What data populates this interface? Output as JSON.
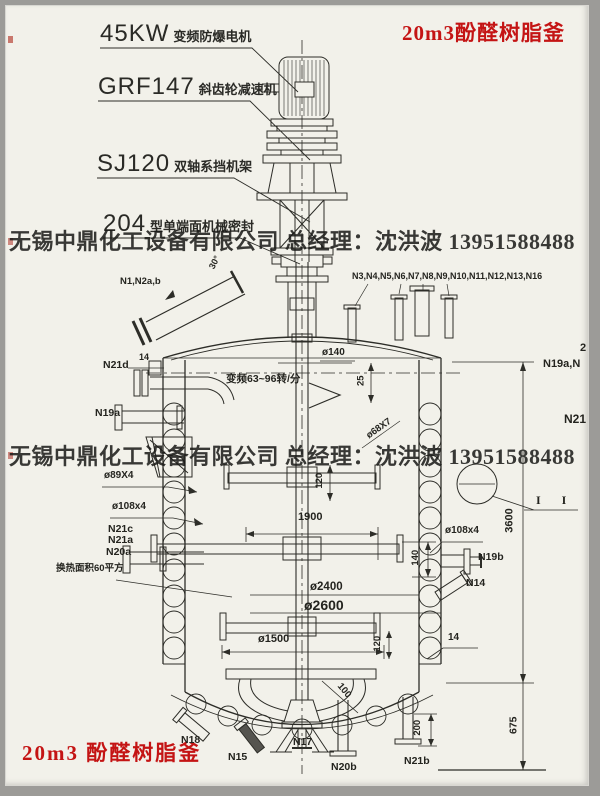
{
  "titles": {
    "top_right": "20m3酚醛树脂釜",
    "bottom_left": "20m3 酚醛树脂釜"
  },
  "watermarks": {
    "line1": "无锡中鼎化工设备有限公司 总经理：沈洪波 13951588488",
    "line2": "无锡中鼎化工设备有限公司 总经理：沈洪波 13951588488"
  },
  "callouts": [
    {
      "code": "45KW",
      "desc": "变频防爆电机"
    },
    {
      "code": "GRF147",
      "desc": "斜齿轮减速机"
    },
    {
      "code": "SJ120",
      "desc": "双轴系挡机架"
    },
    {
      "code": "204",
      "desc": "型单端面机械密封"
    }
  ],
  "nozzles": {
    "top_left": "N1,N2a,b",
    "top_right_row": "N3,N4,N5,N6,N7,N8,N9,N10,N11,N12,N13,N16",
    "n21d": "N21d",
    "n19a": "N19a",
    "n21c": "N21c",
    "n21a": "N21a",
    "n20a": "N20a",
    "n18": "N18",
    "n15": "N15",
    "n17": "N17",
    "n20b": "N20b",
    "n21b": "N21b",
    "n19b": "N19b",
    "n14": "N14",
    "edge_top": "2",
    "edge_mid": "N19a,N",
    "edge_bottom": "N21"
  },
  "dimensions": {
    "shaft_dia": "ø140",
    "dim25": "25",
    "dim14_left": "14",
    "dim14_right": "14",
    "coil_left_1": "ø89X4",
    "coil_left_2": "ø108x4",
    "coil_right": "ø108x4",
    "paddle_span": "1900",
    "dim140": "140",
    "dim120_upper": "120",
    "dim120_lower": "120",
    "dia_inner": "ø2400",
    "dia_outer": "ø2600",
    "dia_anchor": "ø1500",
    "height_shell": "3600",
    "height_bottom": "675",
    "dim200": "200",
    "dim100": "100",
    "coil_pipe": "ø68X7"
  },
  "notes": {
    "speed": "变频63~96转/分",
    "heat_area": "换热面积60平方",
    "angle": "30°",
    "section_mark": "I I"
  },
  "colors": {
    "accent_red": "#c41414",
    "line": "#2d2d28",
    "paper": "#f2f1ea"
  }
}
